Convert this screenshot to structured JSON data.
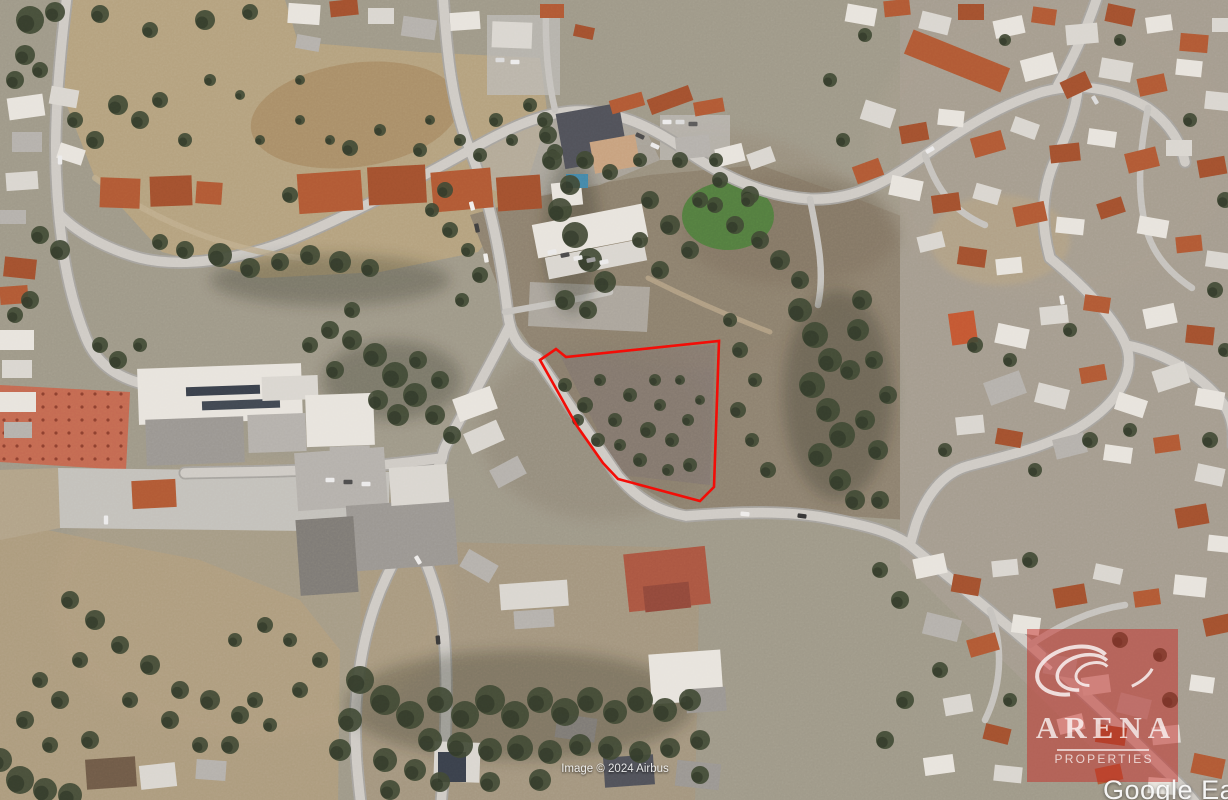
{
  "viewer": {
    "platform_watermark": "Google Earth",
    "imagery_credit": "Image © 2024 Airbus"
  },
  "property_overlay": {
    "boundary_color": "#f30d07",
    "boundary_stroke_px": 2.6,
    "boundary_points": [
      [
        540,
        360
      ],
      [
        556,
        349
      ],
      [
        566,
        357
      ],
      [
        719,
        341
      ],
      [
        714,
        487
      ],
      [
        700,
        501
      ],
      [
        618,
        479
      ],
      [
        603,
        463
      ],
      [
        577,
        426
      ]
    ]
  },
  "agency_watermark": {
    "brand": "ARENA",
    "tagline": "PROPERTIES",
    "panel_tint": "rgba(198,44,38,0.5)",
    "logo_icon": "swirl-globe-icon",
    "text_color": "rgba(255,255,255,0.75)"
  }
}
